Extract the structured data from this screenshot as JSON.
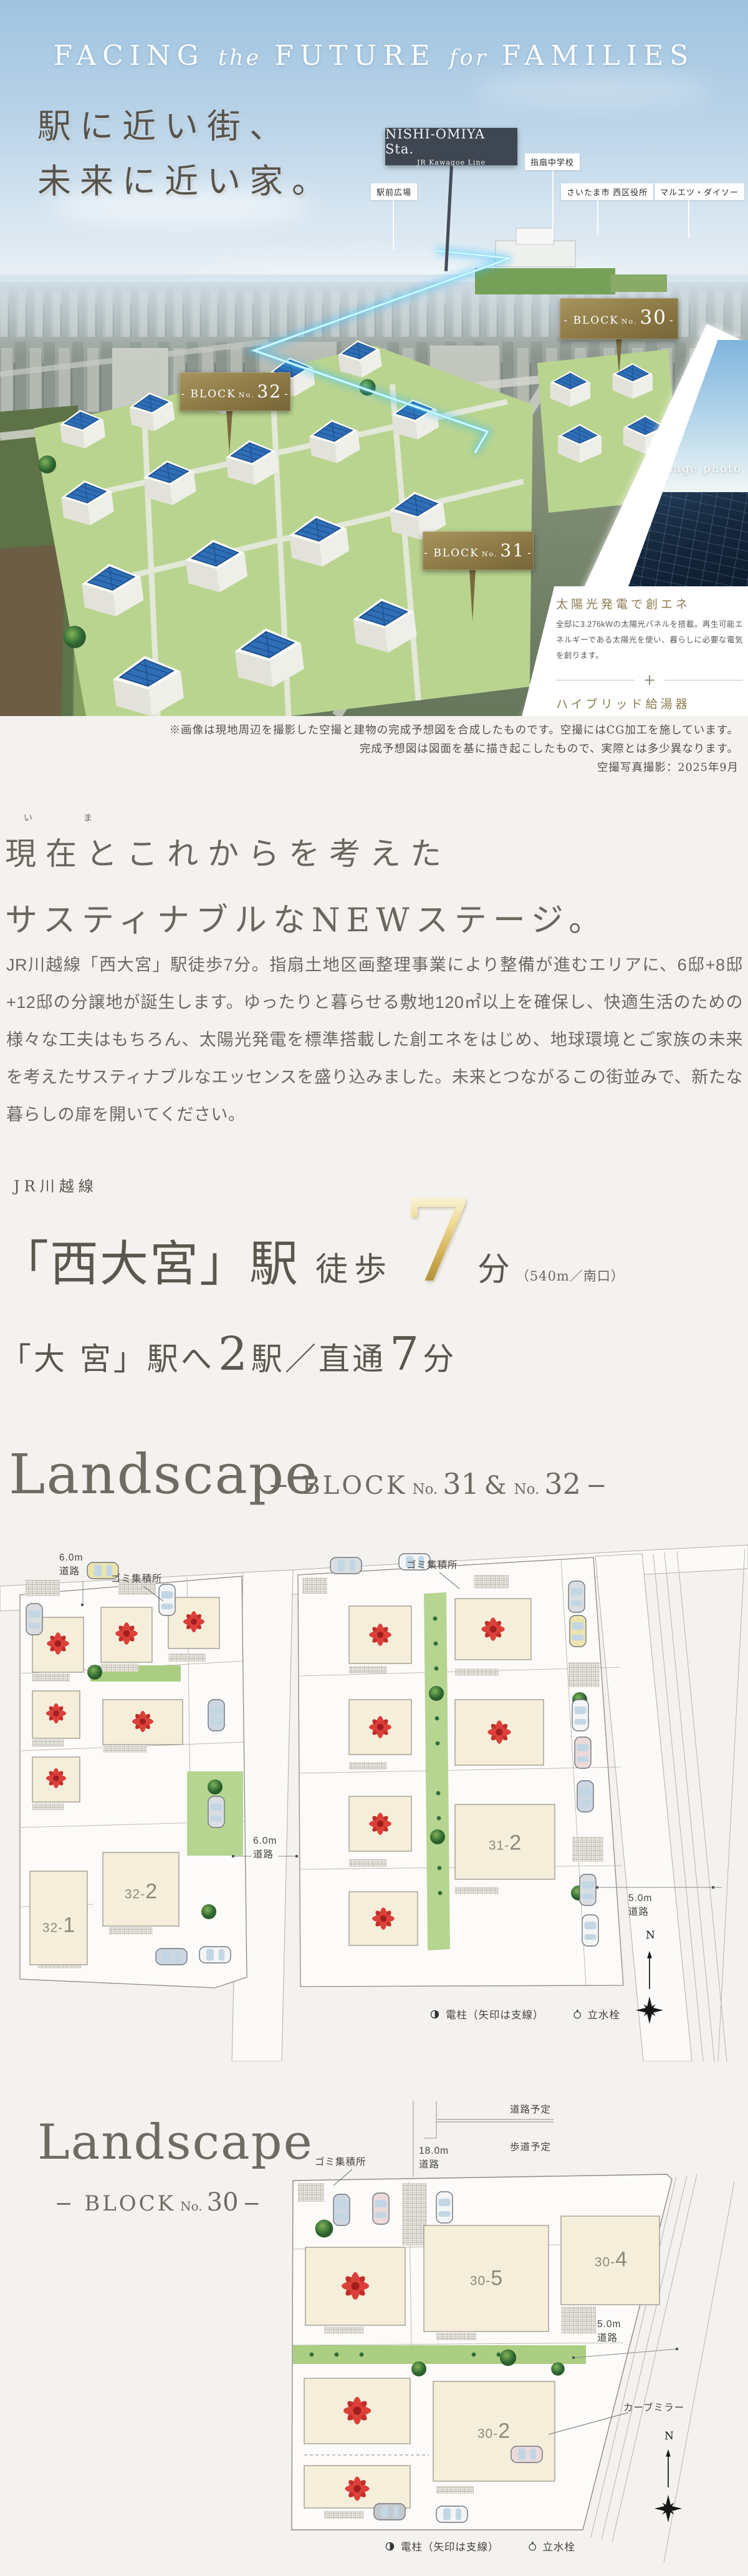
{
  "hero": {
    "title": {
      "w1": "FACING",
      "w2": "the",
      "w3": "FUTURE",
      "w4": "for",
      "w5": "FAMILIES"
    },
    "catch1": "駅に近い街、",
    "catch2": "未来に近い家。",
    "station_sign": {
      "name": "NISHI-OMIYA Sta.",
      "line": "JR Kawagoe Line"
    },
    "labels": {
      "school": "指扇中学校",
      "plaza": "駅前広場",
      "office": "さいたま市 西区役所",
      "store": "マルエツ・ダイソー"
    },
    "signs": [
      {
        "prefix": "- BLOCK",
        "no": "No.",
        "num": "32",
        "suffix": "-"
      },
      {
        "prefix": "- BLOCK",
        "no": "No.",
        "num": "31",
        "suffix": "-"
      },
      {
        "prefix": "- BLOCK",
        "no": "No.",
        "num": "30",
        "suffix": "-"
      }
    ],
    "image_photo": "image photo",
    "features": {
      "item1": {
        "title": "太陽光発電で創エネ",
        "body": "全邸に3.276kWの太陽光パネルを搭載。再生可能エネルギーである太陽光を使い、暮らしに必要な電気を創ります。"
      },
      "plus": "+",
      "item2": {
        "title": "ハイブリッド給湯器",
        "body": "電気とガスで効率良くお湯を沸かすハイブリッド給湯器ECO ONEを採用。優れた省エネ性能で環境保全に貢献します。"
      }
    },
    "caption": {
      "line1": "※画像は現地周辺を撮影した空撮と建物の完成予想図を合成したものです。空撮にはCG加工を施しています。",
      "line2": "完成予想図は図面を基に描き起こしたもので、実際とは多少異なります。",
      "line3": "空撮写真撮影：2025年9月"
    }
  },
  "concept": {
    "furigana": "い　ま",
    "heading1": "現在とこれからを考えた",
    "heading2": "サスティナブルなNEWステージ。",
    "body": "JR川越線「西大宮」駅徒歩7分。指扇土地区画整理事業により整備が進むエリアに、6邸+8邸+12邸の分譲地が誕生します。ゆったりと暮らせる敷地120㎡以上を確保し、快適生活のための様々な工夫はもちろん、太陽光発電を標準搭載した創エネをはじめ、地球環境とご家族の未来を考えたサスティナブルなエッセンスを盛り込みました。未来とつながるこの街並みで、新たな暮らしの扉を開いてください。"
  },
  "access": {
    "line": "JR川越線",
    "station": "「西大宮」駅",
    "walk": "徒歩",
    "minutes": "7",
    "unit": "分",
    "note": "（540m／南口）",
    "row2": {
      "t1": "「大 宮」駅へ",
      "n1": "2",
      "t2": "駅／直通",
      "n2": "7",
      "t3": "分"
    }
  },
  "landscape1": {
    "title": "Landscape",
    "sub": {
      "pre": "− BLOCK",
      "no1": "No.",
      "num1": "31",
      "amp": "&",
      "no2": "No.",
      "num2": "32",
      "suf": "−"
    },
    "labels": {
      "road6_top": {
        "v": "6.0m",
        "w": "道路"
      },
      "gomi": "ゴミ集積所",
      "road6_mid": {
        "v": "6.0m",
        "w": "道路"
      },
      "road5": {
        "v": "5.0m",
        "w": "道路"
      },
      "lot1": {
        "pre": "32-",
        "num": "1"
      },
      "lot2": {
        "pre": "32-",
        "num": "2"
      },
      "lot3": {
        "pre": "31-",
        "num": "2"
      }
    }
  },
  "landscape2": {
    "title": "Landscape",
    "sub": {
      "pre": "− BLOCK",
      "no": "No.",
      "num": "30",
      "suf": "−"
    },
    "labels": {
      "road_plan": "道路予定",
      "walk_plan": "歩道予定",
      "road18": {
        "v": "18.0m",
        "w": "道路"
      },
      "gomi": "ゴミ集積所",
      "road5": {
        "v": "5.0m",
        "w": "道路"
      },
      "mirror": "カーブミラー",
      "lot4": {
        "pre": "30-",
        "num": "4"
      },
      "lot5": {
        "pre": "30-",
        "num": "5"
      },
      "lot2": {
        "pre": "30-",
        "num": "2"
      }
    }
  },
  "legend": {
    "pole": "電柱（矢印は支線）",
    "tap": "立水栓"
  },
  "compass": "N"
}
